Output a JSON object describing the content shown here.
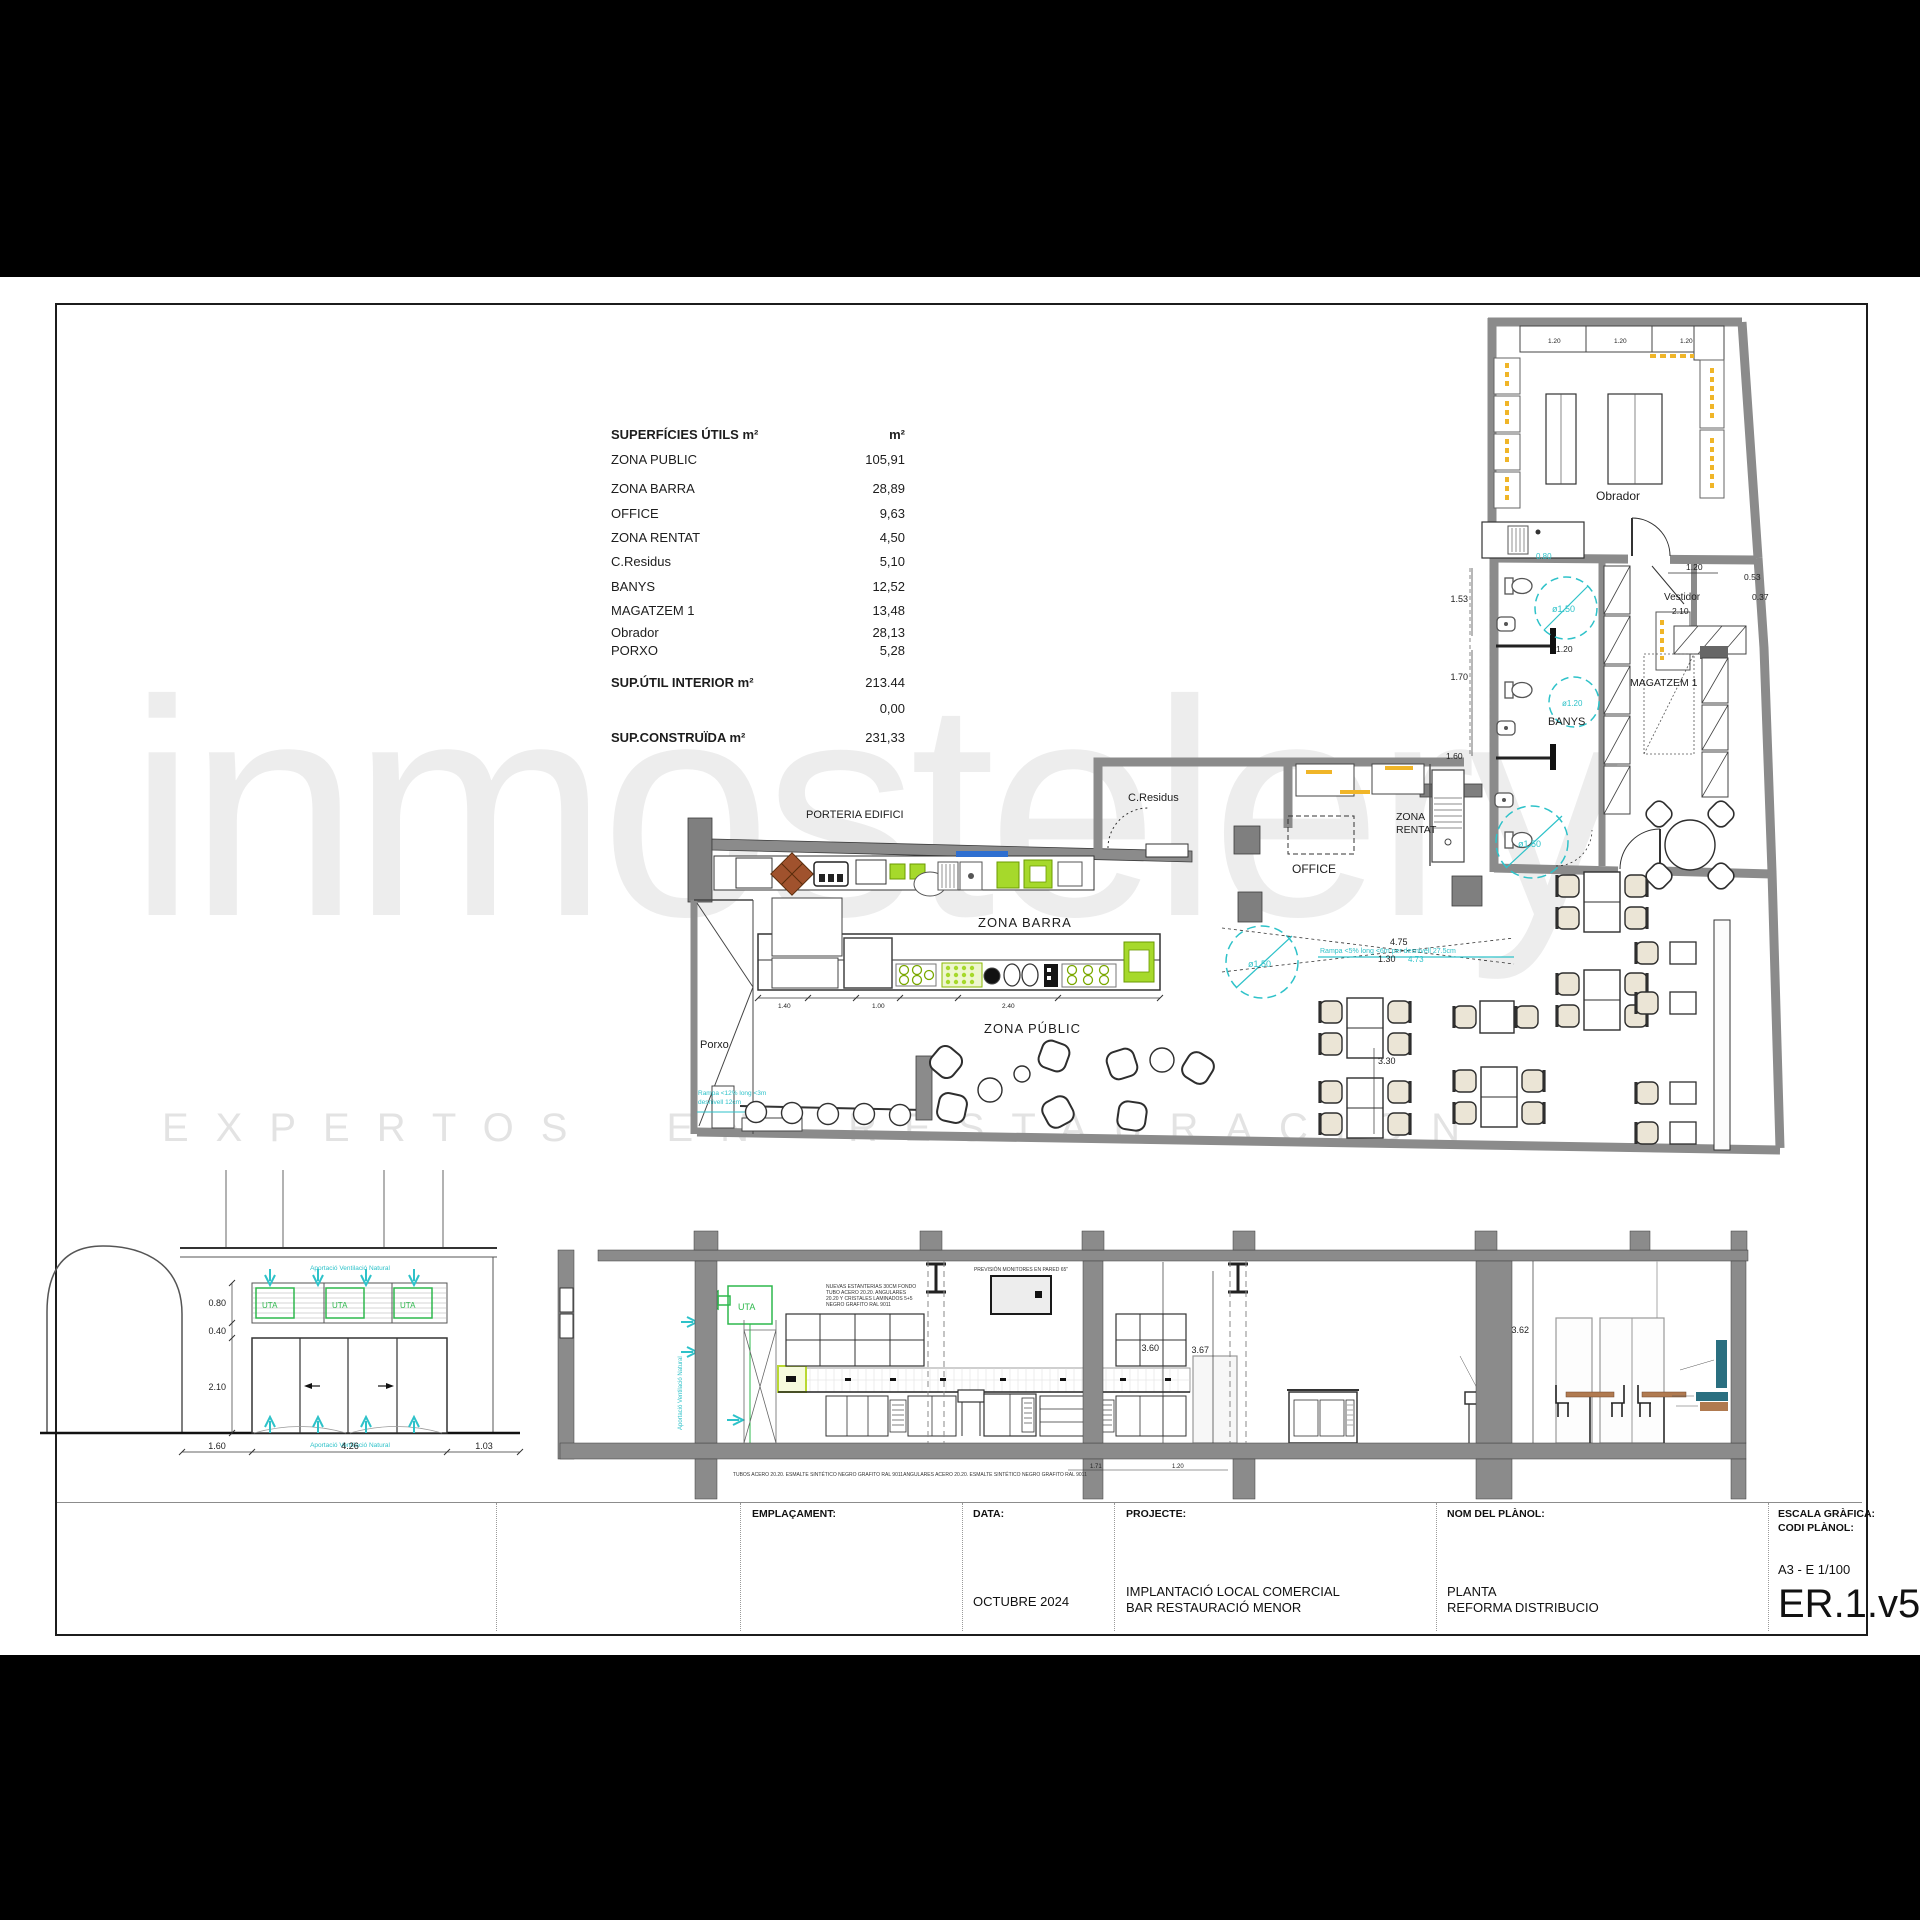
{
  "watermark": {
    "brand": "inmostelery",
    "tagline": "EXPERTOS EN RESTAURACION"
  },
  "surface_table": {
    "title": "SUPERFÍCIES ÚTILS m²",
    "unit": "m²",
    "rows": [
      {
        "label": "ZONA PUBLIC",
        "value": "105,91"
      },
      {
        "label": "ZONA BARRA",
        "value": "28,89"
      },
      {
        "label": "OFFICE",
        "value": "9,63"
      },
      {
        "label": "ZONA RENTAT",
        "value": "4,50"
      },
      {
        "label": "C.Residus",
        "value": "5,10"
      },
      {
        "label": "BANYS",
        "value": "12,52"
      },
      {
        "label": "MAGATZEM 1",
        "value": "13,48"
      },
      {
        "label": "Obrador",
        "value": "28,13"
      },
      {
        "label": "PORXO",
        "value": "5,28"
      }
    ],
    "total_interior": {
      "label": "SUP.ÚTIL INTERIOR m²",
      "value": "213.44"
    },
    "total_blank": {
      "label": "",
      "value": "0,00"
    },
    "total_built": {
      "label": "SUP.CONSTRUÏDA m²",
      "value": "231,33"
    }
  },
  "plan": {
    "labels": {
      "porteria": "PORTERIA EDIFICI",
      "zona_barra": "ZONA BARRA",
      "zona_public": "ZONA PÚBLIC",
      "porxo": "Porxo",
      "c_residus": "C.Residus",
      "office": "OFFICE",
      "zona_rentat_1": "ZONA",
      "zona_rentat_2": "RENTAT",
      "banys": "BANYS",
      "magatzem": "MAGATZEM 1",
      "obrador": "Obrador",
      "vestidor": "Vestidor"
    },
    "access": {
      "d150": "ø1.50",
      "d120": "ø1.20"
    },
    "ramp_public": "Rampa <5% long <6m per desnivell 27.5cm",
    "ramp_porxo_1": "Rampa <12% long <3m",
    "ramp_porxo_2": "desnivell 12cm",
    "dims": {
      "d153": "1.53",
      "d170": "1.70",
      "d120": "1.20",
      "d210": "2.10",
      "d053": "0.53",
      "d037": "0.37",
      "d160": "1.60",
      "d080": "0.80",
      "d330": "3.30",
      "d475": "4.75",
      "d130": "1.30",
      "d473": "4.73",
      "d140": "1.40",
      "d100": "1.00",
      "d240": "2.40"
    }
  },
  "elevation": {
    "uta": "UTA",
    "vent_note": "Aportació Ventilació Natural",
    "dims": {
      "d080": "0.80",
      "d040": "0.40",
      "d210": "2.10",
      "d160": "1.60",
      "d426": "4.26",
      "d103": "1.03"
    }
  },
  "section": {
    "uta": "UTA",
    "dims": {
      "h360": "3.60",
      "h367": "3.67",
      "h362": "3.62",
      "d171": "1.71",
      "d120": "1.20"
    },
    "notes": {
      "shelf_1": "NUEVAS ESTANTERIAS 30CM FONDO",
      "shelf_2": "TUBO ACERO 20.20. ANGULARES",
      "shelf_3": "20.20 Y CRISTALES LAMINADOS 5+5",
      "shelf_4": "NEGRO GRAFITO RAL 9011",
      "tv": "PREVISIÓN MONITORES EN PARED 65\"",
      "bottom_1": "TUBOS ACERO 20.20. ESMALTE SINTÉTICO NEGRO GRAFITO RAL 9011",
      "bottom_2": "ANGULARES ACERO 20.20. ESMALTE SINTÉTICO NEGRO GRAFITO RAL 9011"
    }
  },
  "title_block": {
    "emplacament_label": "EMPLAÇAMENT:",
    "data_label": "DATA:",
    "data_value": "OCTUBRE 2024",
    "projecte_label": "PROJECTE:",
    "projecte_value_1": "IMPLANTACIÓ LOCAL COMERCIAL",
    "projecte_value_2": "BAR RESTAURACIÓ MENOR",
    "nom_label": "NOM DEL PLÀNOL:",
    "nom_value_1": "PLANTA",
    "nom_value_2": "REFORMA DISTRIBUCIO",
    "escala_label": "ESCALA GRÀFICA:",
    "codi_label": "CODI PLÀNOL:",
    "escala_value": "A3 - E 1/100",
    "codi_value": "ER.1.v5"
  }
}
